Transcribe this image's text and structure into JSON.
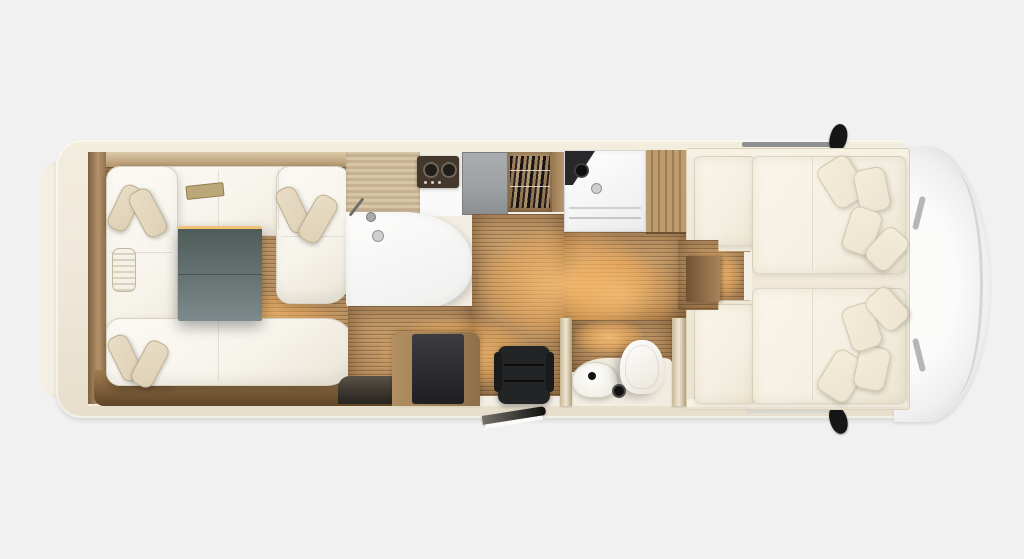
{
  "meta": {
    "type": "floor-plan",
    "subject": "Motorhome interior floor plan, top view, cab at right",
    "canvas_width": 1024,
    "canvas_height": 559
  },
  "palette": {
    "page_bg": "#f1f1f2",
    "body_cream": "#f0e9db",
    "bumper": "#f4efe3",
    "wood": "#a8855c",
    "wood_light": "#d7c5a7",
    "floor": "#b68c5c",
    "floor_hi": "#c89e6c",
    "floor_line": "rgba(61,38,16,0.30)",
    "glow": "#ffc577",
    "sofa_white": "#f7f4ec",
    "cushion": "#ddd0b5",
    "table_gray": "#7e898b",
    "table_dark": "#4f5b59",
    "led": "#f0c276",
    "hob_dark": "#43382b",
    "appliance_gray": "#9da0a2",
    "mattress": "#f4efe1",
    "pillow": "#ece4d0",
    "fixture_white": "#fbfaf6",
    "cab_white": "#fbfbfa",
    "cab_shadow": "#d2d4d6",
    "black": "#161617"
  },
  "regions": [
    {
      "id": "rear-lounge",
      "label": "Rear U-shaped lounge with pillows and table"
    },
    {
      "id": "kitchen",
      "label": "Kitchenette: wood worktop, sink, two-burner hob, fridge, dish rack"
    },
    {
      "id": "shower",
      "label": "Shower cubicle with shower head and drain"
    },
    {
      "id": "wardrobe",
      "label": "Wardrobe cabinet"
    },
    {
      "id": "office",
      "label": "Desk with office chair"
    },
    {
      "id": "washroom",
      "label": "Washroom with basin and toilet"
    },
    {
      "id": "bedroom",
      "label": "Twin single beds with pillows and centre walkway step"
    },
    {
      "id": "cab",
      "label": "Driver cab at vehicle front"
    },
    {
      "id": "exterior",
      "label": "Vehicle body with rear bumper, roof rails, wing mirrors and entry step"
    }
  ]
}
